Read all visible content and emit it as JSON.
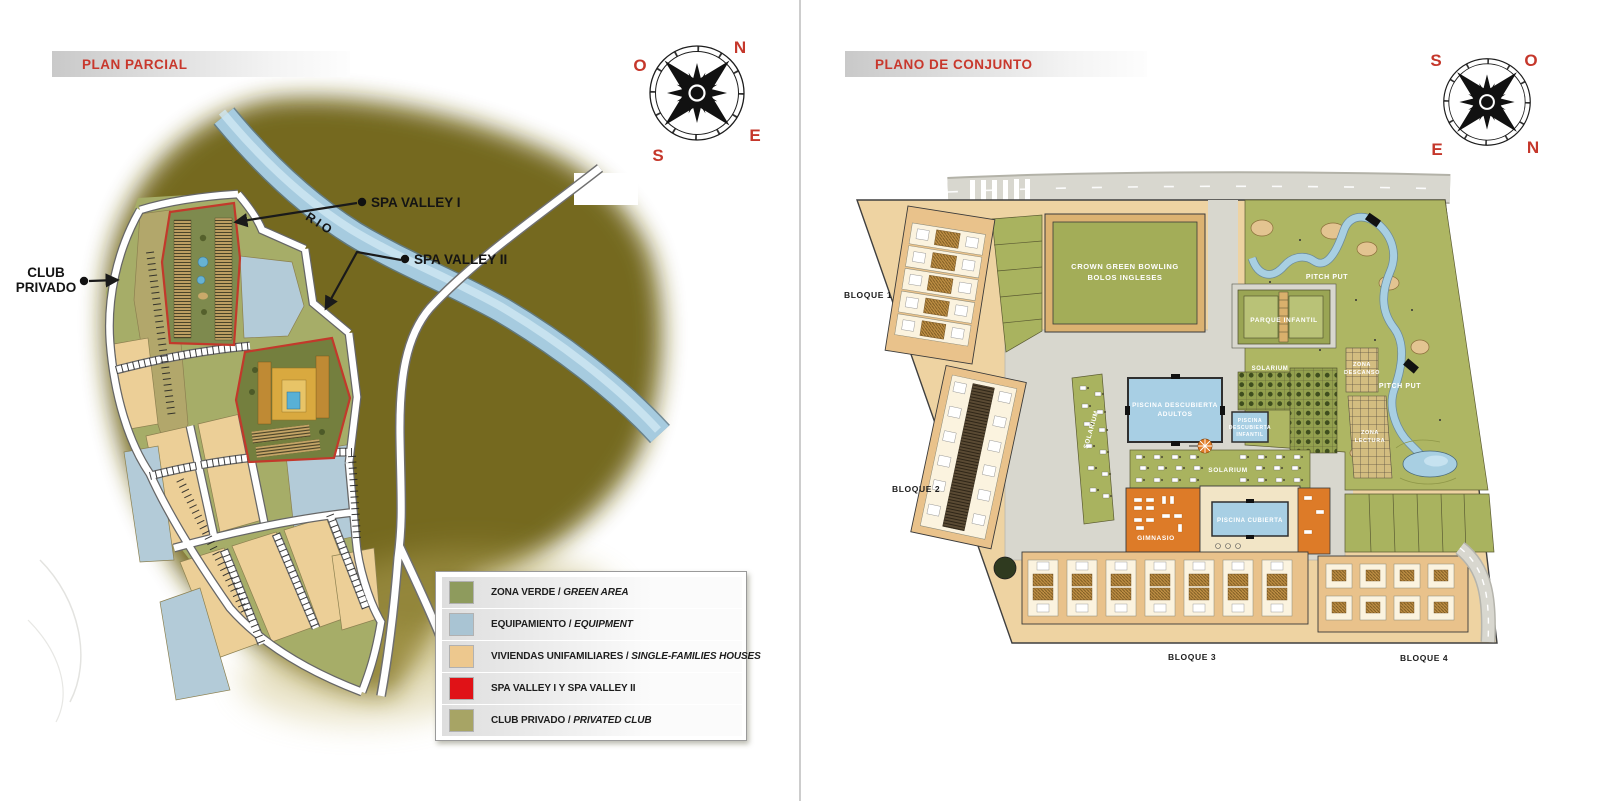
{
  "left_panel": {
    "title": "PLAN PARCIAL",
    "map_labels": {
      "spa_valley_1": "SPA VALLEY I",
      "spa_valley_2": "SPA VALLEY II",
      "club_privado_line1": "CLUB",
      "club_privado_line2": "PRIVADO",
      "rio": "RIO"
    },
    "compass": {
      "n": "N",
      "o": "O",
      "e": "E",
      "s": "S"
    },
    "legend": {
      "items": [
        {
          "swatch": "#8e9b5d",
          "name": "ZONA VERDE",
          "separator": " / ",
          "alt": "GREEN AREA"
        },
        {
          "swatch": "#a9c4d3",
          "name": "EQUIPAMIENTO",
          "separator": " / ",
          "alt": "EQUIPMENT"
        },
        {
          "swatch": "#edc88e",
          "name": "VIVIENDAS UNIFAMILIARES",
          "separator": " / ",
          "alt": "SINGLE-FAMILIES HOUSES"
        },
        {
          "swatch": "#e01217",
          "name": "SPA VALLEY I Y SPA VALLEY II",
          "separator": "",
          "alt": ""
        },
        {
          "swatch": "#a7a465",
          "name": "CLUB PRIVADO",
          "separator": " / ",
          "alt": "PRIVATED CLUB"
        }
      ]
    }
  },
  "right_panel": {
    "title": "PLANO DE CONJUNTO",
    "compass": {
      "s": "S",
      "o": "O",
      "e": "E",
      "n": "N"
    },
    "map_labels": {
      "bloque_1": "BLOQUE 1",
      "bloque_2": "BLOQUE 2",
      "bloque_3": "BLOQUE 3",
      "bloque_4": "BLOQUE 4",
      "bowling_line1": "CROWN GREEN BOWLING",
      "bowling_line2": "BOLOS INGLESES",
      "parque_infantil": "PARQUE INFANTIL",
      "pitch_put_1": "PITCH PUT",
      "pitch_put_2": "PITCH PUT",
      "zona_descanso_line1": "ZONA",
      "zona_descanso_line2": "DESCANSO",
      "zona_lectura_line1": "ZONA",
      "zona_lectura_line2": "LECTURA",
      "solarium_1": "SOLARIUM",
      "solarium_2": "SOLARIUM",
      "solarium_3": "SOLARIUM",
      "piscina_adultos_line1": "PISCINA DESCUBIERTA",
      "piscina_adultos_line2": "ADULTOS",
      "piscina_infantil_line1": "PISCINA",
      "piscina_infantil_line2": "DESCUBIERTA",
      "piscina_infantil_line3": "INFANTIL",
      "piscina_cubierta": "PISCINA CUBIERTA",
      "gimnasio": "GIMNASIO"
    }
  },
  "colors": {
    "accent_red": "#c8372c",
    "terrain_olive": "#6f6418",
    "river_blue": "#a6cbdf",
    "green_area": "#8e9b5d",
    "equipment_blue": "#a9c4d3",
    "housing_tan": "#edc88e",
    "spa_red": "#e01217",
    "club_khaki": "#a7a465",
    "path_gray": "#d8d7ce",
    "orange_building": "#dd7b28"
  }
}
